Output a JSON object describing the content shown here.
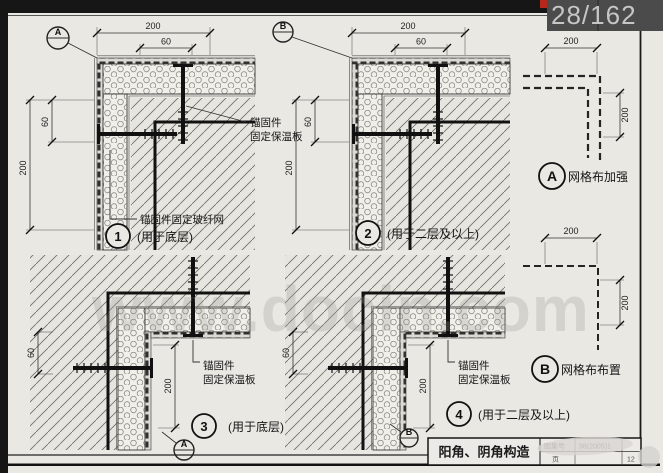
{
  "viewer": {
    "page_counter": "28/162"
  },
  "watermark": "www.docin.com",
  "d1": {
    "callout": "A",
    "dim_top": "200",
    "dim_top_inner": "60",
    "dim_left": "200",
    "dim_left_inner": "60",
    "ann_anchor_1": "锚固件",
    "ann_anchor_2": "固定保温板",
    "ann_mesh": "锚固件固定玻纤网",
    "number": "1",
    "caption": "(用于底层)"
  },
  "d2": {
    "callout": "B",
    "dim_top": "200",
    "dim_top_inner": "60",
    "dim_left": "200",
    "dim_left_inner": "60",
    "number": "2",
    "caption": "(用于二层及以上)"
  },
  "d3": {
    "dim_left": "60",
    "dim_mid": "200",
    "ann_anchor_1": "锚固件",
    "ann_anchor_2": "固定保温板",
    "number": "3",
    "caption": "(用于底层)",
    "callout": "A"
  },
  "d4": {
    "dim_left": "60",
    "dim_mid": "200",
    "ann_anchor_1": "锚固件",
    "ann_anchor_2": "固定保温板",
    "number": "4",
    "caption": "(用于二层及以上)",
    "callout": "B"
  },
  "mesh_a": {
    "letter": "A",
    "label": "网格布加强",
    "dim_top": "200",
    "dim_right": "200"
  },
  "mesh_b": {
    "letter": "B",
    "label": "网格布布置",
    "dim_top": "200",
    "dim_right": "200"
  },
  "titleblock": {
    "title": "阳角、阴角构造",
    "atlas_label": "图集号",
    "atlas_value": "98(2005)1",
    "page_label": "页",
    "page_value": "12"
  }
}
